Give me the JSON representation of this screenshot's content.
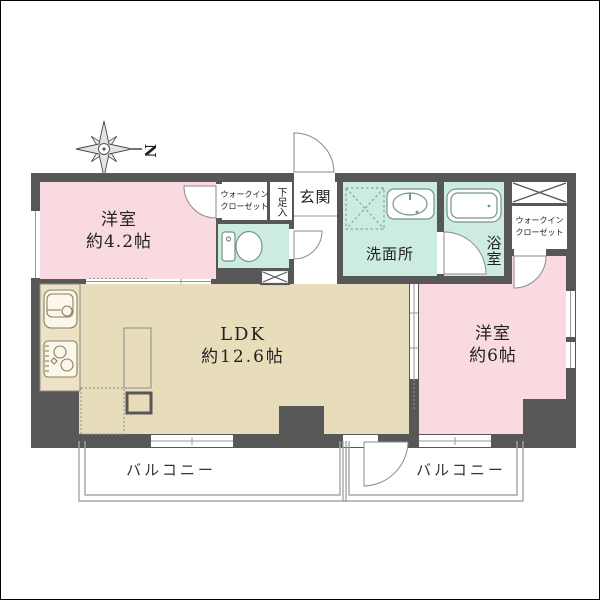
{
  "floorplan": {
    "compass": {
      "label": "N"
    },
    "rooms": {
      "bedroom1": {
        "name": "洋室",
        "size": "約4.2帖"
      },
      "ldk": {
        "name": "LDK",
        "size": "約12.6帖"
      },
      "bedroom2": {
        "name": "洋室",
        "size": "約6帖"
      },
      "entrance": {
        "label": "玄関"
      },
      "washroom": {
        "label": "洗面所"
      },
      "bathroom": {
        "label": "浴室"
      },
      "shoe_box": {
        "label": "下足入"
      },
      "wic_top": {
        "line1": "ウォークイン",
        "line2": "クローゼット"
      },
      "wic_right": {
        "line1": "ウォークイン",
        "line2": "クローゼット"
      },
      "balcony_left": {
        "label": "バルコニー"
      },
      "balcony_right": {
        "label": "バルコニー"
      }
    },
    "icons": {
      "compass": "compass-star-icon",
      "toilet": "toilet-icon",
      "bathtub": "bathtub-icon",
      "washbasin": "washbasin-icon",
      "washer_space": "washing-machine-space-icon",
      "kitchen_sink": "kitchen-sink-icon",
      "stove": "gas-stove-icon",
      "pipe_space": "pipe-space-x-icon"
    },
    "colors": {
      "wall": "#575757",
      "bedroom_pink": "#f9dae1",
      "ldk_beige": "#e8ddbb",
      "wet_teal": "#cdece0",
      "line_gray": "#8a8a8a"
    }
  }
}
